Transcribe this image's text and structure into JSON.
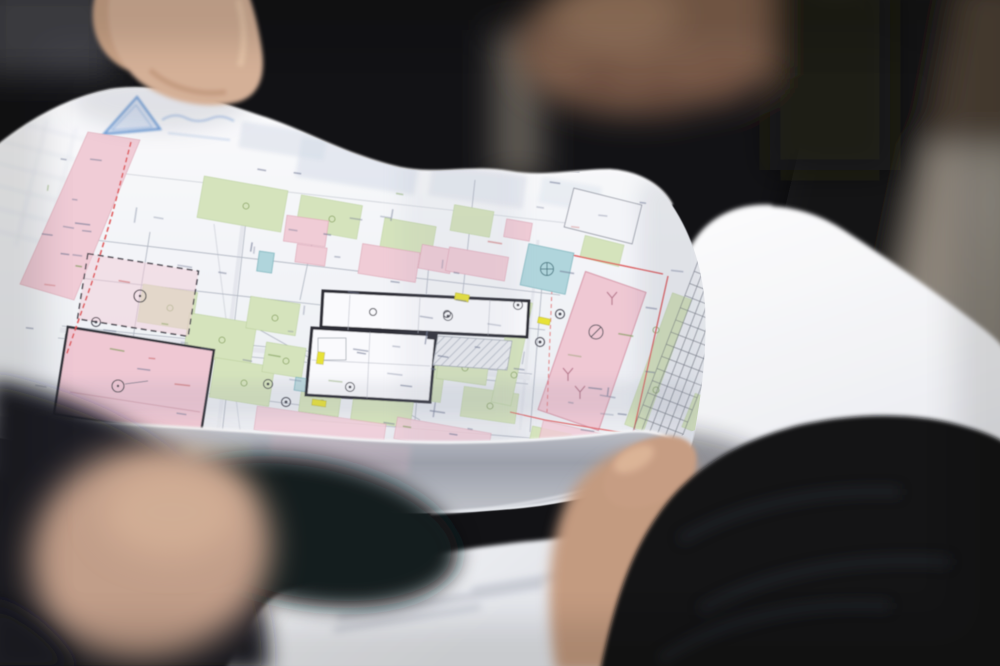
{
  "photo": {
    "alt": "Close-up photograph of hands holding a colour architectural site plan drawing outdoors; a blank folded page behind it, a second document below, and dark out-of-focus people in the background"
  },
  "palette": {
    "paper": "#f7f8fa",
    "plan_pink": "#f3cdd7",
    "plan_green": "#d7e5bc",
    "plan_teal": "#b0d7dd",
    "plan_yellow": "#eae431",
    "plan_red_line": "#e05454",
    "plan_outline": "#2a2a32",
    "stamp_blue": "#5a90d2",
    "skin": "#c9a183",
    "jacket_black": "#0c0d10",
    "background_tan": "#8c8376",
    "curl_gray": "#9b9fa9"
  }
}
